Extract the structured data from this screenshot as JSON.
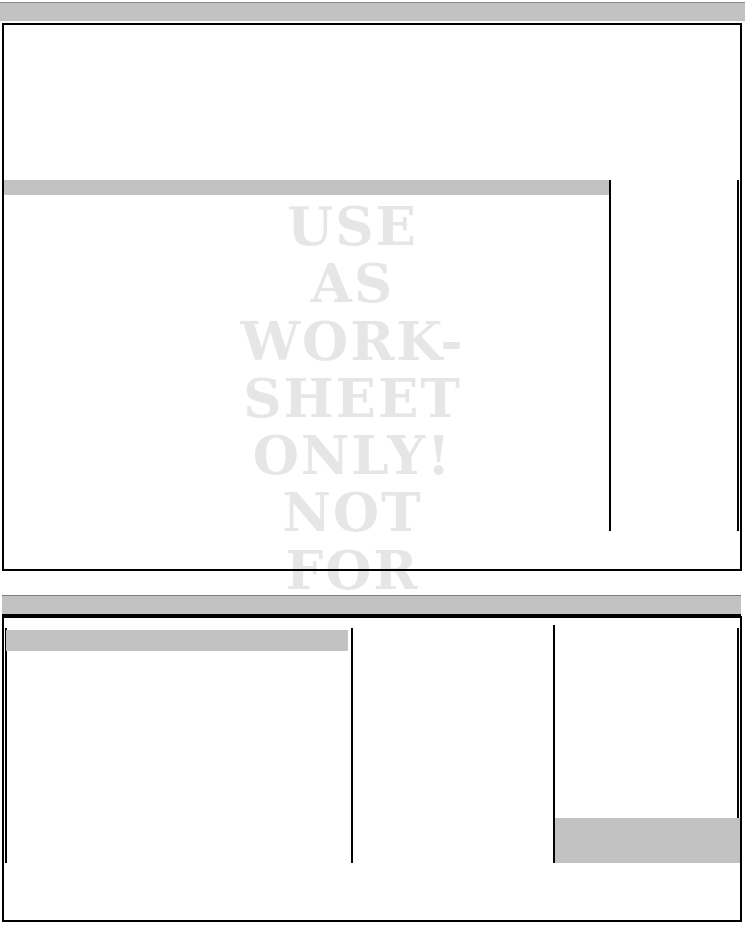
{
  "watermark": {
    "lines": [
      "USE",
      "AS",
      "WORK-",
      "SHEET",
      "ONLY!",
      "NOT",
      "FOR"
    ],
    "color": "#e6e6e6"
  },
  "colors": {
    "header_bar_gray": "#c2c2c2",
    "rule_black": "#000000",
    "page_background": "#ffffff"
  }
}
